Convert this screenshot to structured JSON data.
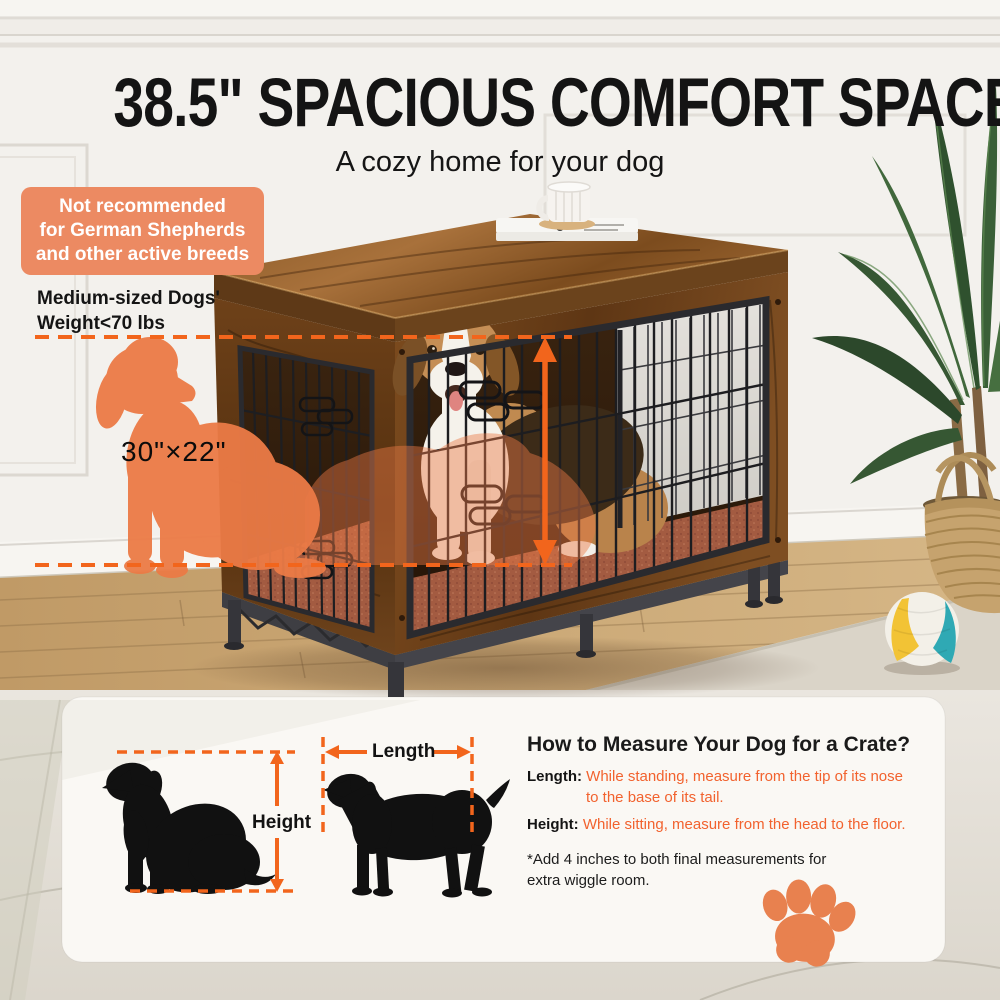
{
  "header": {
    "title": "38.5\" SPACIOUS COMFORT SPACE",
    "subtitle": "A cozy home for your dog"
  },
  "warning_badge": {
    "line1": "Not recommended",
    "line2": "for German Shepherds",
    "line3": "and other active breeds"
  },
  "weight_note": {
    "line1": "Medium-sized Dogs'",
    "line2": "Weight<70 lbs"
  },
  "door_size_label": "30\"×22\"",
  "measure_panel": {
    "title": "How to Measure Your Dog for a Crate?",
    "length_label": "Length:",
    "length_text_line1": "While standing, measure from the tip of its nose",
    "length_text_line2": "to the base of its tail.",
    "height_label": "Height:",
    "height_text": "While sitting, measure from the head to the floor.",
    "note_line1": "*Add 4 inches to both final measurements for",
    "note_line2": "extra wiggle room.",
    "diagram_height_label": "Height",
    "diagram_length_label": "Length"
  },
  "colors": {
    "accent_orange": "#F2651C",
    "badge_orange": "#EC8A62",
    "silhouette_orange": "#EC7B46",
    "instruction_text_orange": "#F2622E",
    "paw_orange": "#E8814F"
  }
}
